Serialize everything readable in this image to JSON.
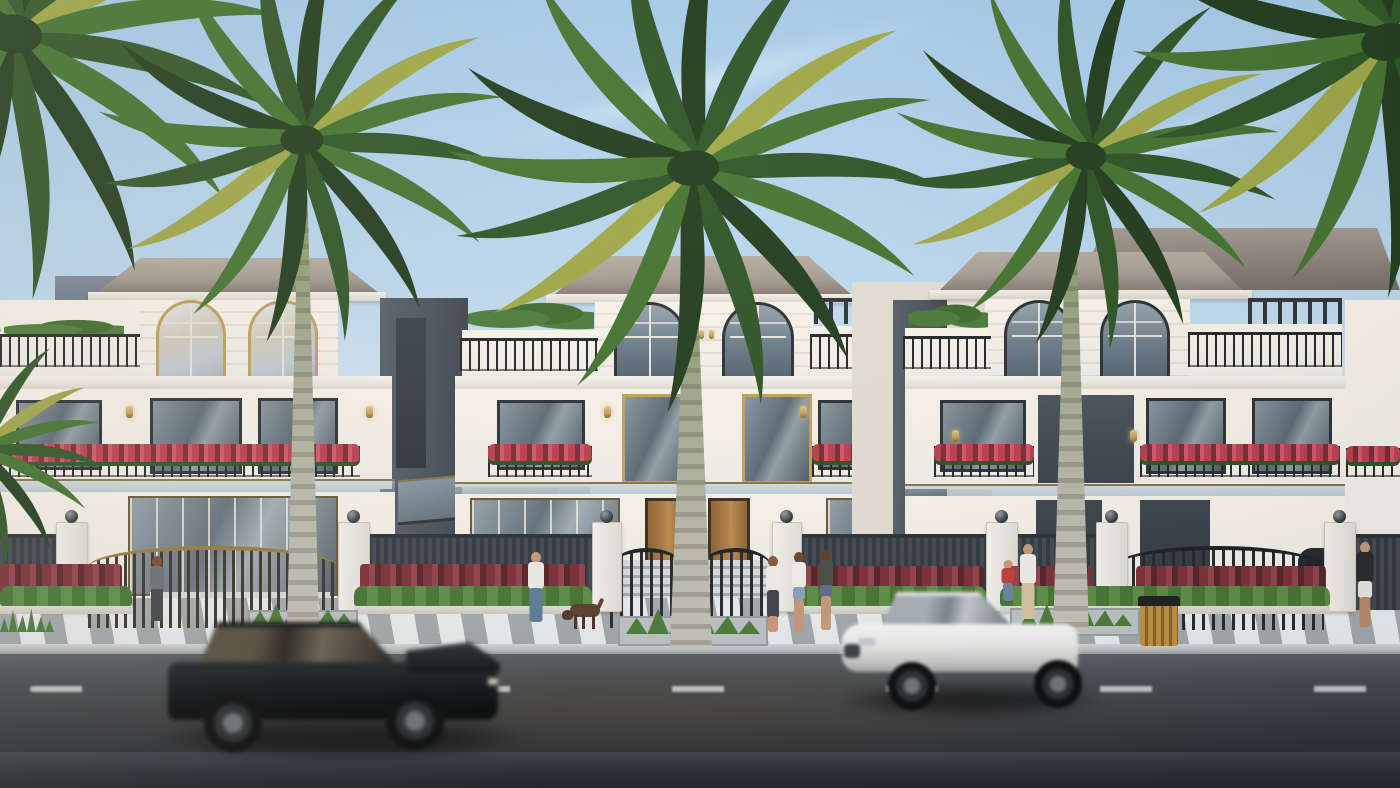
{
  "scene": {
    "setting": "sunny street elevation of a row of white three-storey villas with palm trees",
    "villas": [
      {
        "name": "left-villa",
        "features": [
          "two gold-framed arched windows",
          "long balcony with red flowers",
          "bronze gate"
        ]
      },
      {
        "name": "center-villa",
        "features": [
          "two arched windows",
          "roof terraces with pergolas",
          "two wooden entry doors",
          "curved black gates"
        ]
      },
      {
        "name": "right-villa",
        "features": [
          "two arched windows",
          "long right terrace",
          "red flower balconies",
          "black gate"
        ]
      },
      {
        "name": "partial-villa-right-edge",
        "features": [
          "flower balcony"
        ]
      }
    ],
    "palms": {
      "crowns": 6,
      "visible_trunks": 3
    },
    "vehicles": [
      {
        "name": "black-wagon",
        "state": "driving right, motion blurred"
      },
      {
        "name": "white-sedan",
        "state": "driving left, motion blurred"
      }
    ],
    "pedestrians": [
      "woman-near-left-gate",
      "man-walking-dog",
      "three-women-group",
      "adult-with-child",
      "man-in-black-tshirt"
    ],
    "animals": [
      "brown-dog"
    ],
    "street_furniture": [
      "wooden-trash-bin",
      "white-gate-pillars-with-lamp-balls",
      "striped-sidewalk",
      "red-and-green-hedgerows"
    ]
  },
  "colors": {
    "sky-top": "#a6cbe9",
    "sky-low": "#e4eff7",
    "wall": "#f3f0e9",
    "wall-warm": "#faf5ea",
    "wall-shade": "#e4dfd4",
    "roof": "#a79d93",
    "roof-dark": "#84796f",
    "panel-dark": "#49525a",
    "frame": "#2c3136",
    "gold": "#c3a05e",
    "rail": "#24272a",
    "flower": "#bb4050",
    "flower-dark": "#7c2b34",
    "leaf": "#4c7c38",
    "leaf-dark": "#2e5323",
    "hedge-red": "#7d3036",
    "fence": "#383f45",
    "pillar": "#f1efe8",
    "walk": "#d7dadb",
    "curb": "#c6c9ca",
    "road": "#4b5054",
    "road-dark": "#282b2e",
    "lane": "#d7dadb",
    "frond1": "#223d1c",
    "frond2": "#2f5526",
    "frond3": "#44742f",
    "frond4": "#a0a847",
    "car-black": "#101316",
    "car-white": "#f2f2ef",
    "skin": "#c89a7b",
    "wood-door": "#b08044",
    "bin": "#b5893f"
  }
}
